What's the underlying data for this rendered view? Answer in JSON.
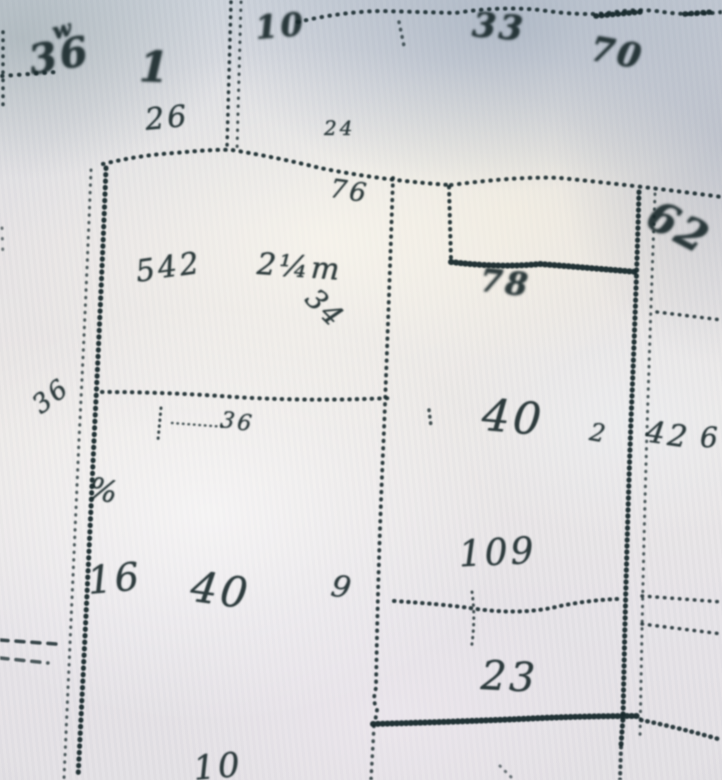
{
  "scene": {
    "kind": "photograph of a plat (survey) map sheet",
    "paper_color": "#e3e2e6",
    "ink_color": "#16282b"
  },
  "map_labels": [
    {
      "name": "squiggle-top-left",
      "text": "w",
      "x": 50,
      "y": 22,
      "size": 22,
      "rot": -15,
      "heavy": true
    },
    {
      "name": "figure-36-top-left",
      "text": "36",
      "x": 26,
      "y": 42,
      "size": 40,
      "rot": -10,
      "heavy": true
    },
    {
      "name": "figure-1-top",
      "text": "1",
      "x": 140,
      "y": 46,
      "size": 42,
      "rot": 2,
      "heavy": true
    },
    {
      "name": "figure-10-top",
      "text": "10",
      "x": 254,
      "y": 12,
      "size": 32,
      "rot": -5,
      "heavy": true
    },
    {
      "name": "figure-26-above-line",
      "text": "26",
      "x": 144,
      "y": 106,
      "size": 30,
      "rot": -5,
      "heavy": false
    },
    {
      "name": "figure-24-small",
      "text": "24",
      "x": 324,
      "y": 118,
      "size": 20,
      "rot": 0,
      "heavy": false
    },
    {
      "name": "figure-76-below-line",
      "text": "76",
      "x": 332,
      "y": 176,
      "size": 26,
      "rot": 8,
      "heavy": false
    },
    {
      "name": "figure-33-top-right",
      "text": "33",
      "x": 474,
      "y": 8,
      "size": 34,
      "rot": 5,
      "heavy": true
    },
    {
      "name": "figure-70-top-right",
      "text": "70",
      "x": 594,
      "y": 32,
      "size": 34,
      "rot": 10,
      "heavy": true
    },
    {
      "name": "figure-542-left-parcel",
      "text": "542",
      "x": 134,
      "y": 258,
      "size": 30,
      "rot": -8,
      "heavy": false
    },
    {
      "name": "figure-2qm-left-parcel",
      "text": "2¼m",
      "x": 258,
      "y": 250,
      "size": 30,
      "rot": 4,
      "heavy": false
    },
    {
      "name": "figure-34-diagonal",
      "text": "34",
      "x": 320,
      "y": 284,
      "size": 28,
      "rot": 45,
      "heavy": false
    },
    {
      "name": "figure-78-step",
      "text": "78",
      "x": 482,
      "y": 264,
      "size": 32,
      "rot": 6,
      "heavy": true
    },
    {
      "name": "figure-62-right-edge",
      "text": "62",
      "x": 660,
      "y": 194,
      "size": 42,
      "rot": 28,
      "heavy": true
    },
    {
      "name": "figure-36-under-line",
      "text": "36",
      "x": 222,
      "y": 410,
      "size": 22,
      "rot": 8,
      "heavy": false
    },
    {
      "name": "figure-36-left-edge",
      "text": "36",
      "x": 28,
      "y": 398,
      "size": 26,
      "rot": -38,
      "heavy": false
    },
    {
      "name": "figure-pct-left",
      "text": "%",
      "x": 92,
      "y": 474,
      "size": 30,
      "rot": 12,
      "heavy": false
    },
    {
      "name": "figure-40-center-parcel",
      "text": "40",
      "x": 484,
      "y": 394,
      "size": 44,
      "rot": 5,
      "heavy": false
    },
    {
      "name": "figure-2-tick",
      "text": "2",
      "x": 592,
      "y": 420,
      "size": 24,
      "rot": 10,
      "heavy": false
    },
    {
      "name": "figure-42-right-strip",
      "text": "42",
      "x": 648,
      "y": 418,
      "size": 30,
      "rot": 8,
      "heavy": false
    },
    {
      "name": "figure-6-right-edge",
      "text": "6",
      "x": 700,
      "y": 424,
      "size": 28,
      "rot": 0,
      "heavy": false
    },
    {
      "name": "figure-16-bottom-left",
      "text": "16",
      "x": 86,
      "y": 562,
      "size": 38,
      "rot": -5,
      "heavy": false
    },
    {
      "name": "figure-40-bottom-parcel",
      "text": "40",
      "x": 194,
      "y": 566,
      "size": 42,
      "rot": 8,
      "heavy": false
    },
    {
      "name": "figure-9-bottom",
      "text": "9",
      "x": 334,
      "y": 572,
      "size": 30,
      "rot": 10,
      "heavy": false
    },
    {
      "name": "figure-109-bottom",
      "text": "109",
      "x": 458,
      "y": 538,
      "size": 36,
      "rot": -3,
      "heavy": false
    },
    {
      "name": "figure-23-bottom-parcel",
      "text": "23",
      "x": 482,
      "y": 656,
      "size": 40,
      "rot": 3,
      "heavy": false
    },
    {
      "name": "figure-10-bottom-edge",
      "text": "10",
      "x": 192,
      "y": 752,
      "size": 34,
      "rot": -5,
      "heavy": false
    }
  ],
  "boundary_lines": [
    {
      "name": "left-edge-vertical-top",
      "d": "M3,32 L3,106",
      "w": 3.5,
      "gap": 7.5,
      "style": "dots",
      "o": 0.85
    },
    {
      "name": "left-edge-row",
      "d": "M2,76 L56,72",
      "w": 4,
      "gap": 8,
      "style": "dots",
      "o": 0.9
    },
    {
      "name": "left-edge-dots-mid",
      "d": "M2,228 L3,258",
      "w": 3,
      "gap": 10,
      "style": "dots",
      "o": 0.6
    },
    {
      "name": "top-center-vertical-a",
      "d": "M231,2 L227,148",
      "w": 3.5,
      "gap": 7,
      "style": "dots",
      "o": 0.9
    },
    {
      "name": "top-center-vertical-b",
      "d": "M241,2 L237,150",
      "w": 3,
      "gap": 7.5,
      "style": "dots",
      "o": 0.8
    },
    {
      "name": "top-boundary-left",
      "d": "M103,164 Q140,155 175,153 Q215,149 232,150 Q280,158 320,168 Q380,180 449,185",
      "w": 4,
      "gap": 7.2,
      "style": "dots",
      "o": 0.92
    },
    {
      "name": "step-vertical",
      "d": "M449,187 L451,260",
      "w": 4,
      "gap": 6.5,
      "style": "dots",
      "o": 0.92
    },
    {
      "name": "step-heavy-horizontal",
      "d": "M451,262 Q500,268 540,264 Q590,268 637,272",
      "w": 6,
      "gap": 4.2,
      "style": "dots",
      "o": 0.95
    },
    {
      "name": "right-vertical-heavy",
      "d": "M639,192 Q636,300 631,420 Q626,560 623,718 L621,745",
      "w": 5,
      "gap": 5.5,
      "style": "dots",
      "o": 0.95
    },
    {
      "name": "right-vertical-heavy-below",
      "d": "M621,747 L620,780",
      "w": 4,
      "gap": 6,
      "style": "dots",
      "o": 0.85
    },
    {
      "name": "right-vertical-light",
      "d": "M655,194 Q651,300 647,430 Q643,560 640,740",
      "w": 3,
      "gap": 7,
      "style": "dots",
      "o": 0.75
    },
    {
      "name": "top-boundary-right",
      "d": "M451,185 Q520,176 560,178 Q640,186 722,197",
      "w": 4,
      "gap": 7.4,
      "style": "dots",
      "o": 0.9
    },
    {
      "name": "top-edge-line",
      "d": "M298,22 Q340,12 380,11 Q420,12 455,13 Q500,6 540,10 Q580,16 608,13 Q640,8 663,12 Q690,16 722,12",
      "w": 4,
      "gap": 7.5,
      "style": "dots",
      "o": 0.88
    },
    {
      "name": "top-edge-heavy-a",
      "d": "M596,16 L640,12",
      "w": 5.5,
      "gap": 5,
      "style": "dots",
      "o": 0.95
    },
    {
      "name": "top-edge-heavy-b",
      "d": "M685,14 L712,12",
      "w": 5.5,
      "gap": 5.5,
      "style": "dots",
      "o": 0.95
    },
    {
      "name": "top-edge-stub",
      "d": "M399,22 L404,46",
      "w": 3.5,
      "gap": 7,
      "style": "dots",
      "o": 0.7
    },
    {
      "name": "right-row-315",
      "d": "M657,312 L722,320",
      "w": 3.5,
      "gap": 7,
      "style": "dots",
      "o": 0.85
    },
    {
      "name": "left-vertical-light",
      "d": "M91,170 Q86,300 79,440 Q72,600 64,778",
      "w": 3,
      "gap": 7,
      "style": "dots",
      "o": 0.75
    },
    {
      "name": "left-vertical-heavy",
      "d": "M106,168 Q101,300 94,440 Q87,600 78,778",
      "w": 5,
      "gap": 6,
      "style": "dots",
      "o": 0.95
    },
    {
      "name": "left-parcel-bottom",
      "d": "M102,392 Q160,392 220,396 Q300,402 392,398",
      "w": 4,
      "gap": 7,
      "style": "dots",
      "o": 0.9
    },
    {
      "name": "tick-428",
      "d": "M429,410 L431,426",
      "w": 3.5,
      "gap": 6,
      "style": "dots",
      "o": 0.8
    },
    {
      "name": "bracket-tick",
      "d": "M161,408 L158,440",
      "w": 3,
      "gap": 5.5,
      "style": "dots",
      "o": 0.85
    },
    {
      "name": "bracket-row",
      "d": "M172,423 L226,427",
      "w": 2.5,
      "gap": 5,
      "style": "dots",
      "o": 0.75
    },
    {
      "name": "center-vertical",
      "d": "M393,178 Q389,300 384,430 Q378,560 376,688 Q372,700 377,710 L375,722",
      "w": 3.8,
      "gap": 6.8,
      "style": "dots",
      "o": 0.9
    },
    {
      "name": "center-vertical-below",
      "d": "M374,726 L371,780",
      "w": 3.5,
      "gap": 7,
      "style": "dots",
      "o": 0.8
    },
    {
      "name": "mid-line-600",
      "d": "M394,601 Q440,604 470,608 Q520,616 560,606 Q590,600 618,599",
      "w": 4,
      "gap": 6.5,
      "style": "dots",
      "o": 0.9
    },
    {
      "name": "cross-tick-600",
      "d": "M472,592 Q476,620 471,650",
      "w": 3,
      "gap": 6,
      "style": "dots",
      "o": 0.8
    },
    {
      "name": "right-row-595",
      "d": "M642,596 L722,602",
      "w": 3.5,
      "gap": 7,
      "style": "dots",
      "o": 0.85
    },
    {
      "name": "right-row-625",
      "d": "M642,624 L722,634",
      "w": 3.5,
      "gap": 7,
      "style": "dots",
      "o": 0.85
    },
    {
      "name": "bottom-heavy-line",
      "d": "M373,724 Q450,722 520,719 Q580,716 639,716",
      "w": 6,
      "gap": 4.2,
      "style": "dots",
      "o": 0.95
    },
    {
      "name": "bottom-right-dots",
      "d": "M641,720 Q680,728 722,740",
      "w": 4.5,
      "gap": 6,
      "style": "dots",
      "o": 0.9
    },
    {
      "name": "bottom-left-dash-row-1",
      "d": "M0,640 L56,644",
      "w": 3.5,
      "gap": 8,
      "style": "dash",
      "o": 0.85
    },
    {
      "name": "bottom-left-dash-row-2",
      "d": "M0,658 L48,663",
      "w": 3.5,
      "gap": 8,
      "style": "dash",
      "o": 0.75
    },
    {
      "name": "bottom-small-dots",
      "d": "M500,766 L512,778",
      "w": 3,
      "gap": 7,
      "style": "dots",
      "o": 0.6
    }
  ]
}
